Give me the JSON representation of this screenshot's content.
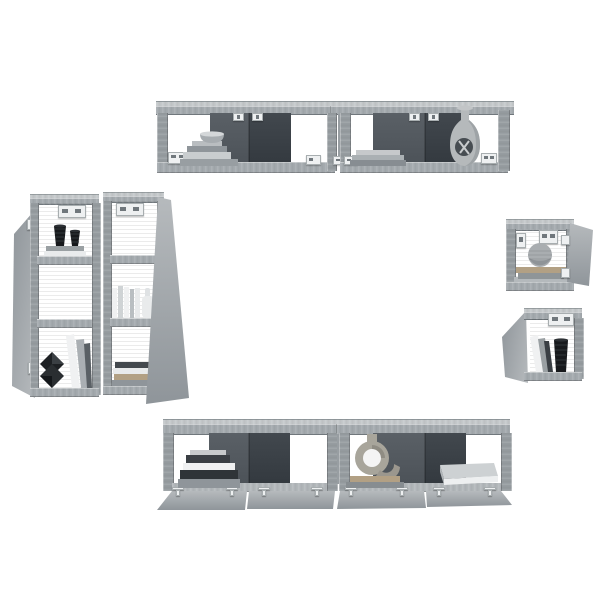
{
  "scene": {
    "type": "product-photo",
    "subject": "6-piece wall-mounted TV cabinet set, gray sonoma oak finish, shown staged with decor on white background",
    "background": "#ffffff"
  },
  "colors": {
    "bg": "#ffffff",
    "wood_top_light": "#c6cacc",
    "wood_top": "#b7bcbf",
    "wood_face": "#a6acb0",
    "wood_side": "#989ea2",
    "wood_edge": "#70777c",
    "door_light": "#b6babd",
    "door_shade": "#8f959a",
    "panel_mid": "#5a6066",
    "panel_mid_dk": "#4c5258",
    "panel_dark": "#42484e",
    "panel_dark_dk": "#33393f",
    "back_brown": "#7a5940",
    "back_brown_dark": "#60442e",
    "back_light": "#c7cacc",
    "floor_gray": "#b4b9bc",
    "metal_white": "#eef0f1",
    "metal_gray": "#9aa0a3",
    "black_decor": "#17191c",
    "ridge_gray": "#32363a",
    "book_white": "#f0f1f2",
    "book_gray": "#8f959a",
    "book_dark": "#3a3f44",
    "book_tan": "#b2a084",
    "vase_gray": "#b5b9bb",
    "sphere_gray": "#a9adb0",
    "ring_tan": "#a8a59b"
  },
  "units": [
    {
      "id": "top-wall-cabinet",
      "description": "horizontal two-module wall cabinet, four open compartments, partial dark back panels",
      "decor": [
        "gray bowl on stepped book stack",
        "stack of books",
        "gourd vase with circular cutout and twigs"
      ]
    },
    {
      "id": "left-tall-cabinet-pair",
      "description": "two tall three-shelf wall cabinets, left door open left, right door open right, brown hardboard backs",
      "decor": [
        "two black ribbed vases on books",
        "white books with bottle vase",
        "black faceted ornament with leaning books",
        "stack of books"
      ]
    },
    {
      "id": "right-small-cabinet-top",
      "description": "small square wall cabinet, door open to the right",
      "decor": [
        "gray sphere on two books"
      ]
    },
    {
      "id": "right-small-cabinet-bottom",
      "description": "small square wall cabinet, door open to the left",
      "decor": [
        "leaning books",
        "black ribbed vase"
      ]
    },
    {
      "id": "bottom-wall-cabinet",
      "description": "horizontal two-module cabinet with four fold-down doors open, metal hinges visible",
      "decor": [
        "stepped book stack",
        "ring sculpture on two books",
        "flat gray box"
      ]
    }
  ],
  "hardware": [
    "wall-mount brackets",
    "door hinges",
    "fold-down door hinges"
  ]
}
